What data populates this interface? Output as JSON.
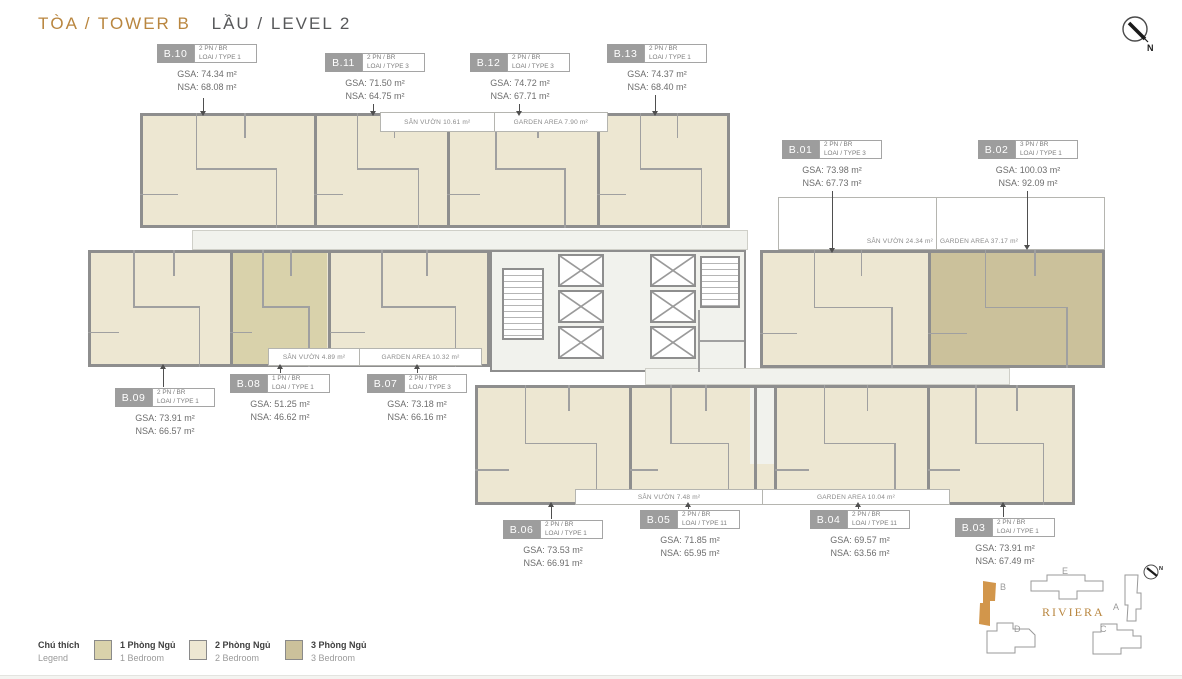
{
  "header": {
    "tower": "TÒA / TOWER B",
    "level": "LẦU / LEVEL 2"
  },
  "compass": {
    "north": "N"
  },
  "units": [
    {
      "id": "B.10",
      "bedrooms": "2 PN / BR",
      "type": "LOAI / TYPE 1",
      "gsa": "GSA: 74.34 m²",
      "nsa": "NSA: 68.08 m²"
    },
    {
      "id": "B.11",
      "bedrooms": "2 PN / BR",
      "type": "LOAI / TYPE 3",
      "gsa": "GSA: 71.50 m²",
      "nsa": "NSA: 64.75 m²"
    },
    {
      "id": "B.12",
      "bedrooms": "2 PN / BR",
      "type": "LOAI / TYPE 3",
      "gsa": "GSA: 74.72 m²",
      "nsa": "NSA: 67.71 m²"
    },
    {
      "id": "B.13",
      "bedrooms": "2 PN / BR",
      "type": "LOAI / TYPE 1",
      "gsa": "GSA: 74.37 m²",
      "nsa": "NSA: 68.40 m²"
    },
    {
      "id": "B.01",
      "bedrooms": "2 PN / BR",
      "type": "LOAI / TYPE 3",
      "gsa": "GSA: 73.98 m²",
      "nsa": "NSA: 67.73 m²"
    },
    {
      "id": "B.02",
      "bedrooms": "3 PN / BR",
      "type": "LOAI / TYPE 1",
      "gsa": "GSA: 100.03 m²",
      "nsa": "NSA: 92.09 m²"
    },
    {
      "id": "B.09",
      "bedrooms": "2 PN / BR",
      "type": "LOAI / TYPE 1",
      "gsa": "GSA: 73.91 m²",
      "nsa": "NSA: 66.57 m²"
    },
    {
      "id": "B.08",
      "bedrooms": "1 PN / BR",
      "type": "LOAI / TYPE 1",
      "gsa": "GSA: 51.25 m²",
      "nsa": "NSA: 46.62 m²"
    },
    {
      "id": "B.07",
      "bedrooms": "2 PN / BR",
      "type": "LOAI / TYPE 3",
      "gsa": "GSA: 73.18 m²",
      "nsa": "NSA: 66.16 m²"
    },
    {
      "id": "B.06",
      "bedrooms": "2 PN / BR",
      "type": "LOAI / TYPE 1",
      "gsa": "GSA: 73.53 m²",
      "nsa": "NSA: 66.91 m²"
    },
    {
      "id": "B.05",
      "bedrooms": "2 PN / BR",
      "type": "LOAI / TYPE 11",
      "gsa": "GSA: 71.85 m²",
      "nsa": "NSA: 65.95 m²"
    },
    {
      "id": "B.04",
      "bedrooms": "2 PN / BR",
      "type": "LOAI / TYPE 11",
      "gsa": "GSA: 69.57 m²",
      "nsa": "NSA: 63.56 m²"
    },
    {
      "id": "B.03",
      "bedrooms": "2 PN / BR",
      "type": "LOAI / TYPE 1",
      "gsa": "GSA: 73.91 m²",
      "nsa": "NSA: 67.49 m²"
    }
  ],
  "gardens": {
    "top": {
      "san_vuon": "SÂN VƯỜN 10.61 m²",
      "garden_area": "GARDEN AREA 7.90 m²"
    },
    "middle": {
      "san_vuon": "SÂN VƯỜN 4.89 m²",
      "garden_area": "GARDEN AREA 10.32 m²"
    },
    "right": {
      "san_vuon": "SÂN VƯỜN 24.34 m²",
      "garden_area": "GARDEN AREA 37.17 m²"
    },
    "bottom": {
      "san_vuon": "SÂN VƯỜN 7.48 m²",
      "garden_area": "GARDEN AREA 10.04 m²"
    }
  },
  "legend": {
    "title": "Chú thích",
    "subtitle": "Legend",
    "items": [
      {
        "label": "1 Phòng Ngủ",
        "sublabel": "1 Bedroom",
        "color": "#d9d2ab"
      },
      {
        "label": "2 Phòng Ngủ",
        "sublabel": "2 Bedroom",
        "color": "#ede7d2"
      },
      {
        "label": "3 Phòng Ngủ",
        "sublabel": "3 Bedroom",
        "color": "#cbc19b"
      }
    ]
  },
  "sitemap": {
    "project": "RIVIERA",
    "highlight": "B",
    "buildings": {
      "a": "A",
      "b": "B",
      "c": "C",
      "d": "D",
      "e": "E"
    },
    "north": "N"
  },
  "colors": {
    "accent_gold": "#b9863f",
    "unit_badge_gray": "#9d9d9d",
    "bedroom1": "#d9d2ab",
    "bedroom2": "#ede7d2",
    "bedroom3": "#cbc19b",
    "wall_gray": "#8e8e8e",
    "highlight_building": "#d2964b"
  }
}
